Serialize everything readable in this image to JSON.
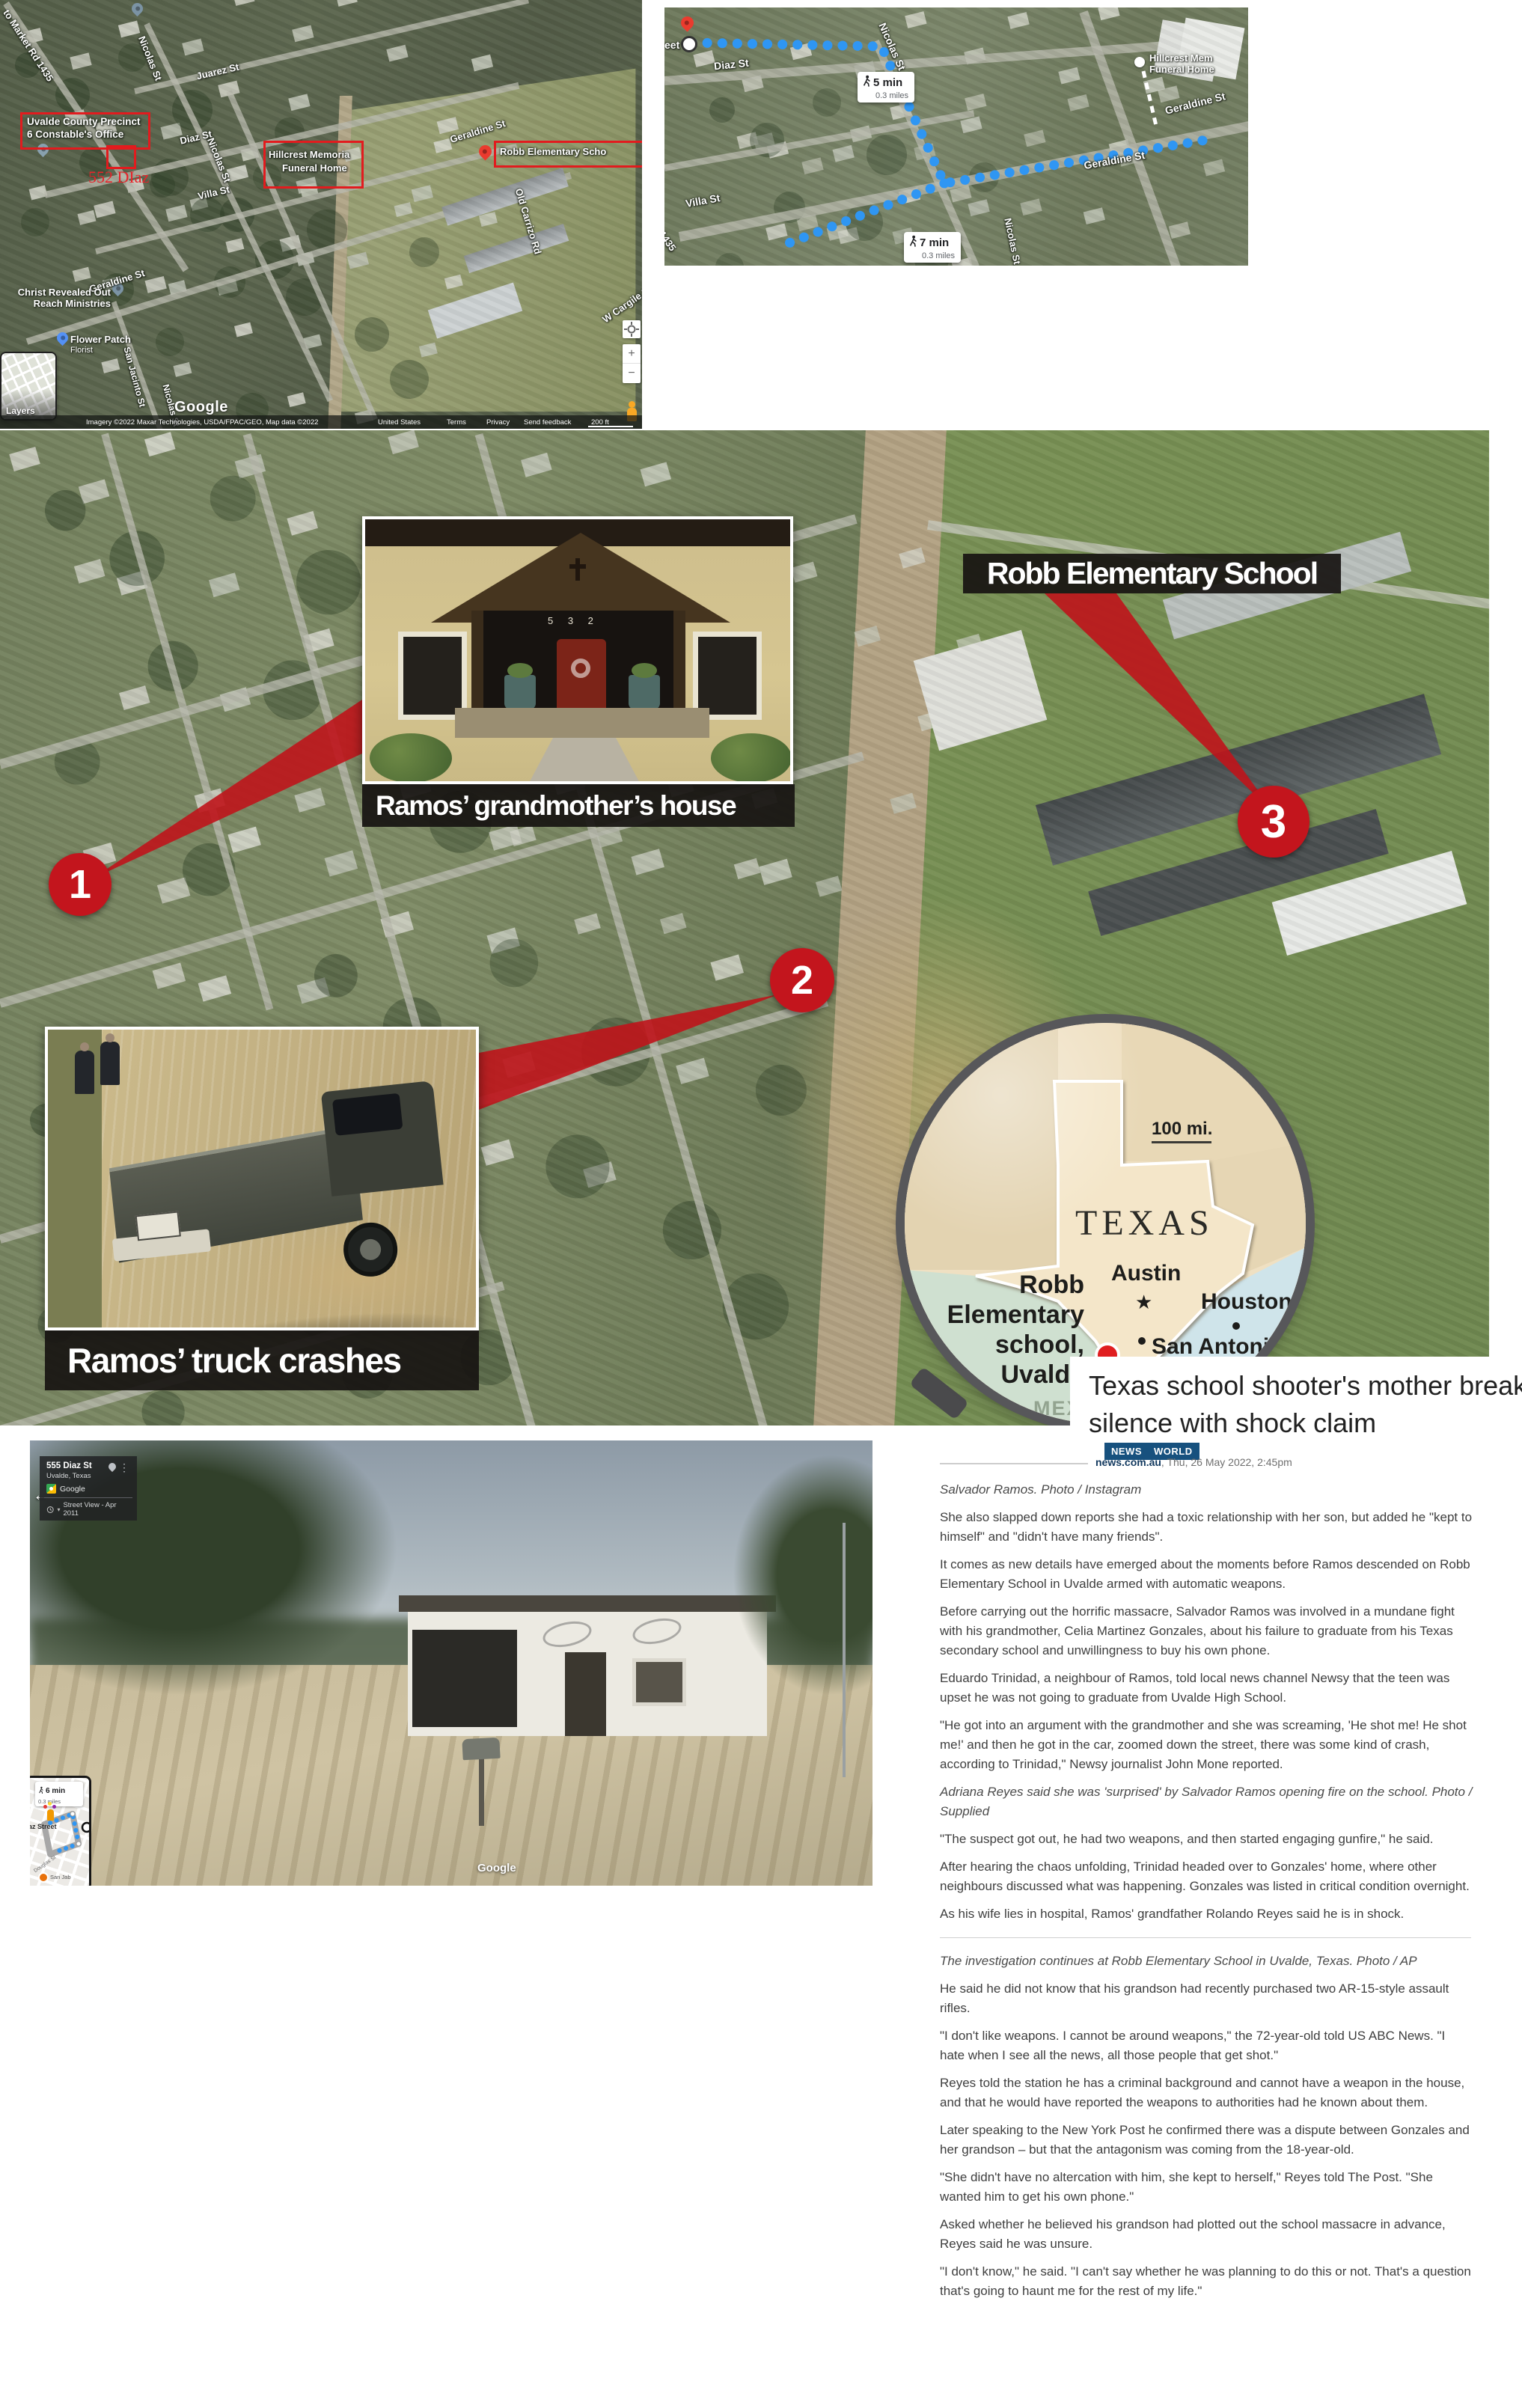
{
  "top_left_map": {
    "constable_box": {
      "line1": "Uvalde County Precinct",
      "line2": "6 Constable's Office"
    },
    "address_label": "552 DIaz",
    "hillcrest_box": {
      "line1": "Hillcrest Memoria",
      "line2": "Funeral Home"
    },
    "robb_box": {
      "label": "Robb Elementary Scho"
    },
    "christ_poi": {
      "line1": "Christ Revealed Out",
      "line2": "Reach Ministries"
    },
    "flower_poi": {
      "line1": "Flower Patch",
      "line2": "Florist"
    },
    "streets": {
      "market_rd": "to Market Rd 1435",
      "nicolas": "Nicolas St",
      "juarez": "Juarez St",
      "diaz": "Diaz St",
      "villa": "Villa St",
      "geraldine": "Geraldine St",
      "san_jacinto": "San Jacinto St",
      "old_carrizo": "Old Carrizo Rd",
      "w_cargile": "W Cargile S"
    },
    "layers_label": "Layers",
    "google_logo": "Google",
    "attribution": "Imagery ©2022 Maxar Technologies, USDA/FPAC/GEO, Map data ©2022",
    "links": {
      "region": "United States",
      "terms": "Terms",
      "privacy": "Privacy",
      "feedback": "Send feedback"
    },
    "scale": "200 ft",
    "zoom_in": "+",
    "zoom_out": "−"
  },
  "top_right_map": {
    "partial_street": "eet",
    "walk_badge_1": {
      "time": "5 min",
      "distance": "0.3 miles"
    },
    "walk_badge_2": {
      "time": "7 min",
      "distance": "0.3 miles"
    },
    "hillcrest_poi": {
      "line1": "Hillcrest Mem",
      "line2": "Funeral Home"
    },
    "streets": {
      "diaz": "Diaz St",
      "nicolas": "Nicolas St",
      "villa": "Villa St",
      "geraldine": "Geraldine St",
      "rd1435": "1435"
    }
  },
  "aerial": {
    "school_label": "Robb Elementary School",
    "grandmother_label": "Ramos’ grandmother’s house",
    "truck_label": "Ramos’ truck crashes",
    "marker1": "1",
    "marker2": "2",
    "marker3": "3",
    "house_number": "5 3 2"
  },
  "inset_map": {
    "scale_label": "100 mi.",
    "state": "TEXAS",
    "place": {
      "line1": "Robb",
      "line2": "Elementary",
      "line3": "school,",
      "line4": "Uvalde"
    },
    "austin": "Austin",
    "houston": "Houston",
    "san_antonio": "San Antonio",
    "mexico": "MEX"
  },
  "headline": {
    "title_line1": "Texas school shooter's mother breaks",
    "title_line2": "silence with shock claim",
    "badge1": "NEWS",
    "badge2": "WORLD",
    "source": "news.com.au",
    "dateline": ", Thu, 26 May 2022, 2:45pm"
  },
  "street_view": {
    "back_arrow": "←",
    "card": {
      "title": "555 Diaz St",
      "subtitle": "Uvalde, Texas",
      "brand": "Google",
      "history": "Street View - Apr 2011",
      "menu": "⋮",
      "chevron": "▾"
    },
    "minimap": {
      "time": "6 min",
      "distance": "0.3 miles",
      "street": "az Street",
      "street2": "Douglas St",
      "poi": "San Jab"
    },
    "watermark": "Google"
  },
  "article": {
    "blocks": [
      {
        "style": "caption",
        "text": "Salvador Ramos. Photo / Instagram"
      },
      {
        "style": "body",
        "text": "She also slapped down reports she had a toxic relationship with her son, but added he \"kept to himself\" and \"didn't have many friends\"."
      },
      {
        "style": "body",
        "text": "It comes as new details have emerged about the moments before Ramos descended on Robb Elementary School in Uvalde armed with automatic weapons."
      },
      {
        "style": "body",
        "text": "Before carrying out the horrific massacre, Salvador Ramos was involved in a mundane fight with his grandmother, Celia Martinez Gonzales, about his failure to graduate from his Texas secondary school and unwillingness to buy his own phone."
      },
      {
        "style": "body",
        "text": "Eduardo Trinidad, a neighbour of Ramos, told local news channel Newsy that the teen was upset he was not going to graduate from Uvalde High School."
      },
      {
        "style": "body",
        "text": "\"He got into an argument with the grandmother and she was screaming, 'He shot me! He shot me!' and then he got in the car, zoomed down the street, there was some kind of crash, according to Trinidad,\" Newsy journalist John Mone reported."
      },
      {
        "style": "caption",
        "text": "Adriana Reyes said she was 'surprised' by Salvador Ramos opening fire on the school. Photo / Supplied"
      },
      {
        "style": "body",
        "text": "\"The suspect got out, he had two weapons, and then started engaging gunfire,\" he said."
      },
      {
        "style": "body",
        "text": "After hearing the chaos unfolding, Trinidad headed over to Gonzales' home, where other neighbours discussed what was happening. Gonzales was listed in critical condition overnight."
      },
      {
        "style": "body",
        "text": "As his wife lies in hospital, Ramos' grandfather Rolando Reyes said he is in shock."
      },
      {
        "style": "caption",
        "text": "The investigation continues at Robb Elementary School in Uvalde, Texas. Photo / AP"
      },
      {
        "style": "body",
        "text": "He said he did not know that his grandson had recently purchased two AR-15-style assault rifles."
      },
      {
        "style": "body",
        "text": "\"I don't like weapons. I cannot be around weapons,\" the 72-year-old told US ABC News. \"I hate when I see all the news, all those people that get shot.\""
      },
      {
        "style": "body",
        "text": "Reyes told the station he has a criminal background and cannot have a weapon in the house, and that he would have reported the weapons to authorities had he known about them."
      },
      {
        "style": "body",
        "text": "Later speaking to the New York Post he confirmed there was a dispute between Gonzales and her grandson – but that the antagonism was coming from the 18-year-old."
      },
      {
        "style": "body",
        "text": "\"She didn't have no altercation with him, she kept to herself,\" Reyes told The Post. \"She wanted him to get his own phone.\""
      },
      {
        "style": "body",
        "text": "Asked whether he believed his grandson had plotted out the school massacre in advance, Reyes said he was unsure."
      },
      {
        "style": "body",
        "text": "\"I don't know,\" he said. \"I can't say whether he was planning to do this or not. That's a question that's going to haunt me for the rest of my life.\""
      }
    ]
  }
}
